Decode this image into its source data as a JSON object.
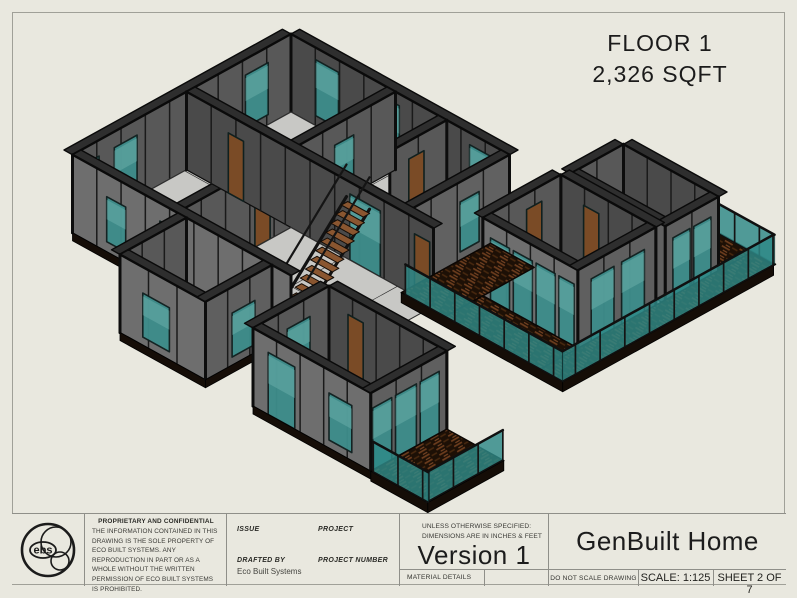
{
  "annotation": {
    "line1": "FLOOR 1",
    "line2": "2,326 SQFT"
  },
  "title_block": {
    "logo_text": "ebs",
    "proprietary": {
      "heading": "PROPRIETARY AND CONFIDENTIAL",
      "body": "THE INFORMATION CONTAINED IN THIS DRAWING IS THE SOLE PROPERTY OF ECO BUILT SYSTEMS.  ANY REPRODUCTION IN PART OR AS A WHOLE WITHOUT THE WRITTEN PERMISSION OF ECO BUILT SYSTEMS IS PROHIBITED."
    },
    "fields": {
      "issue_label": "ISSUE",
      "project_label": "PROJECT",
      "drafted_by_label": "DRAFTED BY",
      "drafted_by_value": "Eco Built Systems",
      "project_number_label": "PROJECT NUMBER"
    },
    "tolerance_note": {
      "line1": "UNLESS OTHERWISE SPECIFIED:",
      "line2": "DIMENSIONS ARE IN INCHES & FEET"
    },
    "version": "Version 1",
    "material_details_label": "MATERIAL DETAILS",
    "title": "GenBuilt Home",
    "do_not_scale": "DO NOT SCALE DRAWING",
    "scale": "SCALE: 1:125",
    "sheet_number": "SHEET 2 OF 7"
  },
  "colors": {
    "sheet_bg": "#e9e8df",
    "border_line": "#a0a098",
    "wall_outer_gray": "#6e6e6e",
    "wall_inner_gray": "#4a4a4a",
    "wall_cap": "#2e2e2e",
    "frame_black": "#0d0d0d",
    "floor_gray": "#c8c8c5",
    "glass_teal": "#3d8d8b",
    "railing_teal": "#2f8a88",
    "deck_wood_dark": "#1d1006",
    "deck_wood_light": "#6b3c1d",
    "door_brown": "#7a4b26",
    "stair_tread": "#8a5630",
    "text_dark": "#1b1b1b"
  }
}
